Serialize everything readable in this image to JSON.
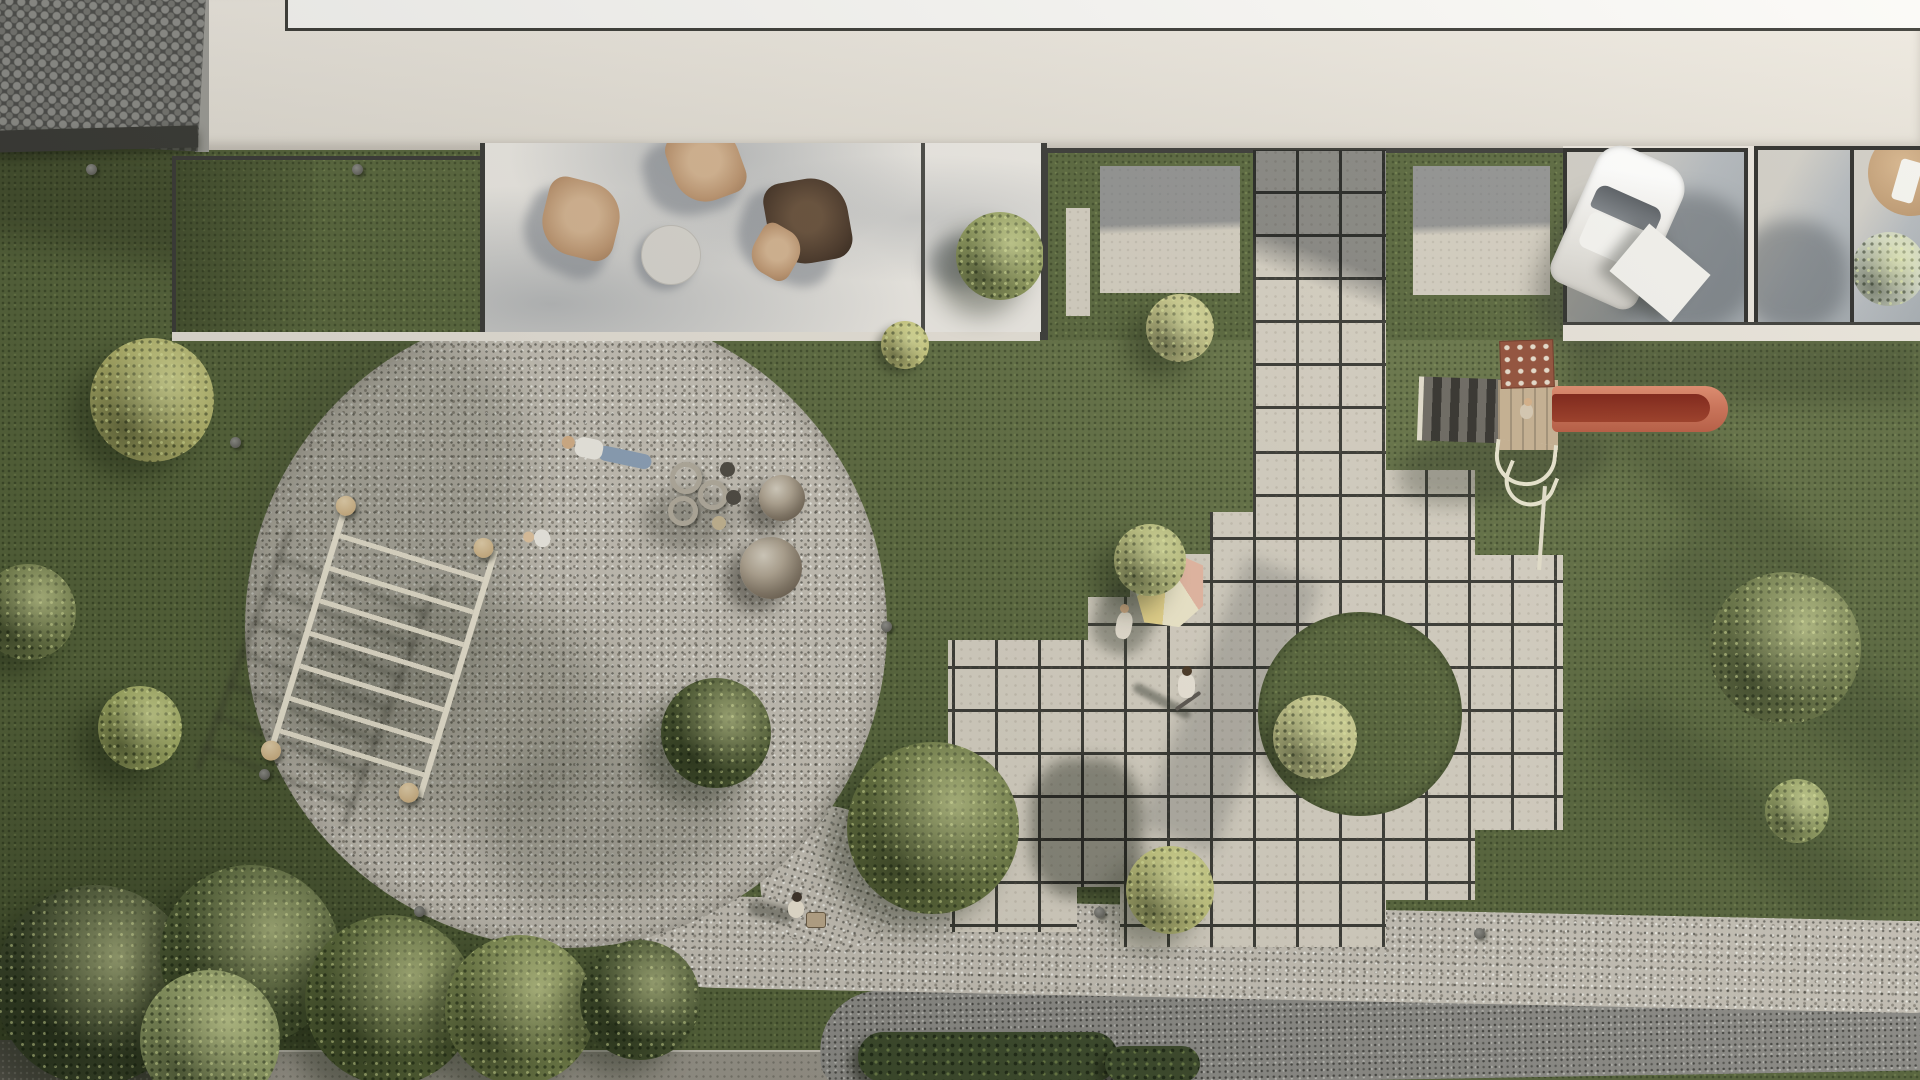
{
  "page": {
    "title": "Aerial view rendering of residential courtyard with playground",
    "type": "photorealistic top-down 3D architectural visualization",
    "canvas": {
      "width": 1920,
      "height": 1080
    }
  },
  "palette": {
    "grass": "#5a683e",
    "grass_shade": "#3f4a2c",
    "paving_tile": "#d8d2c5",
    "tile_joint": "#3a3a35",
    "gravel_light": "#c8c3b9",
    "gravel_dark": "#8d8c88",
    "cobblestone": "#4e4e4c",
    "roof_cream": "#ece7df",
    "roof_white": "#fbfaf8",
    "frame_dark": "#3b3b38",
    "glass_gray": "#aab0b6",
    "shadow_blue_gray": "#6c7280",
    "chair_tan": "#c7a183",
    "chair_brown": "#4b3a2d",
    "slide_red": "#cd7156",
    "slide_channel": "#7e2014",
    "climb_wall": "#94503a",
    "ladder_cream": "#ece6d4",
    "wood_ball": "#c8a878",
    "sphere_metal": "#837767",
    "teepee_pink": "#e9bba6",
    "teepee_yellow": "#ecd98f",
    "teepee_green": "#cdd6b0",
    "car_white": "#f6f5f2"
  },
  "scene": {
    "labels": {
      "roof": "cream building roof slab",
      "upper_roof": "white upper roof level",
      "cobblestone": "cobblestone pavement corner",
      "side_wall": "building side wall",
      "lawn_patio": "framed lawn light-well",
      "terrace": "glazed terrace with butterfly chairs",
      "coffee_table": "round coffee table",
      "terrace_tree": "potted tree on terrace",
      "zone": "roof-edge lawn with concrete pads",
      "carport": "glass skylight carport",
      "car": "white car parked on carport",
      "storage_cube": "white storage cube",
      "patio_parasol": "tan parasol on lower patio",
      "walkway": "paving-slab walkway spine",
      "plaza": "stepped paving-slab plaza",
      "island": "circular grass island",
      "playground": "circular gravel playground",
      "monkey_bars": "overhead ladder play frame",
      "sphere_large": "large metal play sphere",
      "sphere_small": "small metal play sphere",
      "spring_riders": "spring rider seats",
      "teepee": "striped play teepee tent",
      "slide_tower": "wooden slide tower with climbing wall",
      "slide": "red slide",
      "gravel_path": "curved gravel path",
      "sidewalk": "concrete sidewalk",
      "hedge": "hedge row",
      "tree": "tree canopy",
      "bush": "shrub",
      "bollard": "ground light bollard",
      "person_lying": "person lying on gravel",
      "toddler": "toddler on playground",
      "scooter_kid": "child with scooter on plaza",
      "plaza_teen": "teenager at plaza edge",
      "stroller_person": "adult with toy cart",
      "slide_child": "child on slide platform"
    },
    "counts": {
      "butterfly_chairs": 3,
      "skylight_panels": 3,
      "concrete_pads": 3,
      "play_spheres": 2,
      "bollards": 8,
      "people": 6,
      "trees_and_bushes": 20
    },
    "layout_notes": {
      "tile_size_px": 43,
      "playground_center": [
        566,
        627
      ],
      "playground_radius": 321,
      "grass_island_center": [
        1360,
        714
      ],
      "sun_direction": "upper-right, shadows cast to lower-left"
    }
  }
}
